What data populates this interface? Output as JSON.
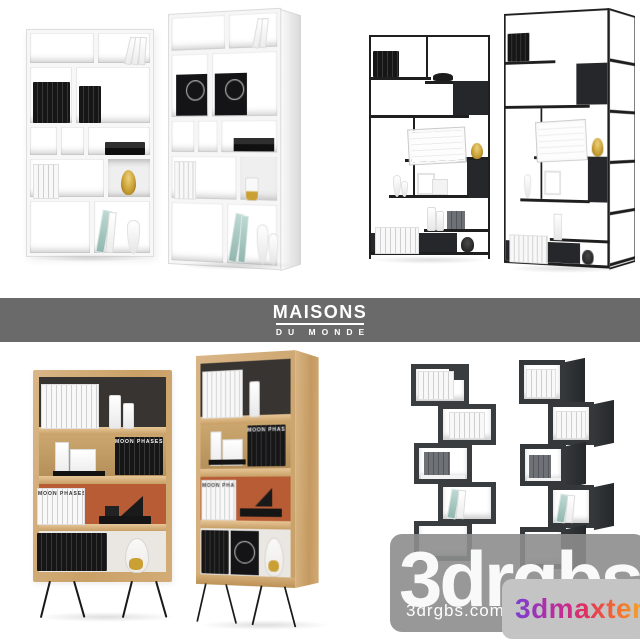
{
  "banner": {
    "title": "MAISONS",
    "subtitle": "DU MONDE",
    "background": "#6a6a6a",
    "text_color": "#ffffff"
  },
  "watermark": {
    "big": "3drgbs",
    "site": "3drgbs.com",
    "badge": "3dmaxter",
    "overlay_color": "#8d8d8d",
    "badge_background": "#c4c4c4",
    "badge_text_gradient": [
      "#7b3fd0",
      "#c52b92",
      "#e0315f",
      "#f06a31",
      "#f7a726"
    ]
  },
  "labels": {
    "moon_phases": "MOON PHASES"
  },
  "palette": {
    "white_shelf": "#fafafa",
    "metal_black": "#1f1f1f",
    "oak_wood": "#d2ab79",
    "orange_backboard": "#b85c35",
    "black_backboard": "#373431",
    "zigzag_gray": "#3a3d40",
    "amber_glass": "#caa035",
    "teal_book": "#9fc4bc"
  }
}
